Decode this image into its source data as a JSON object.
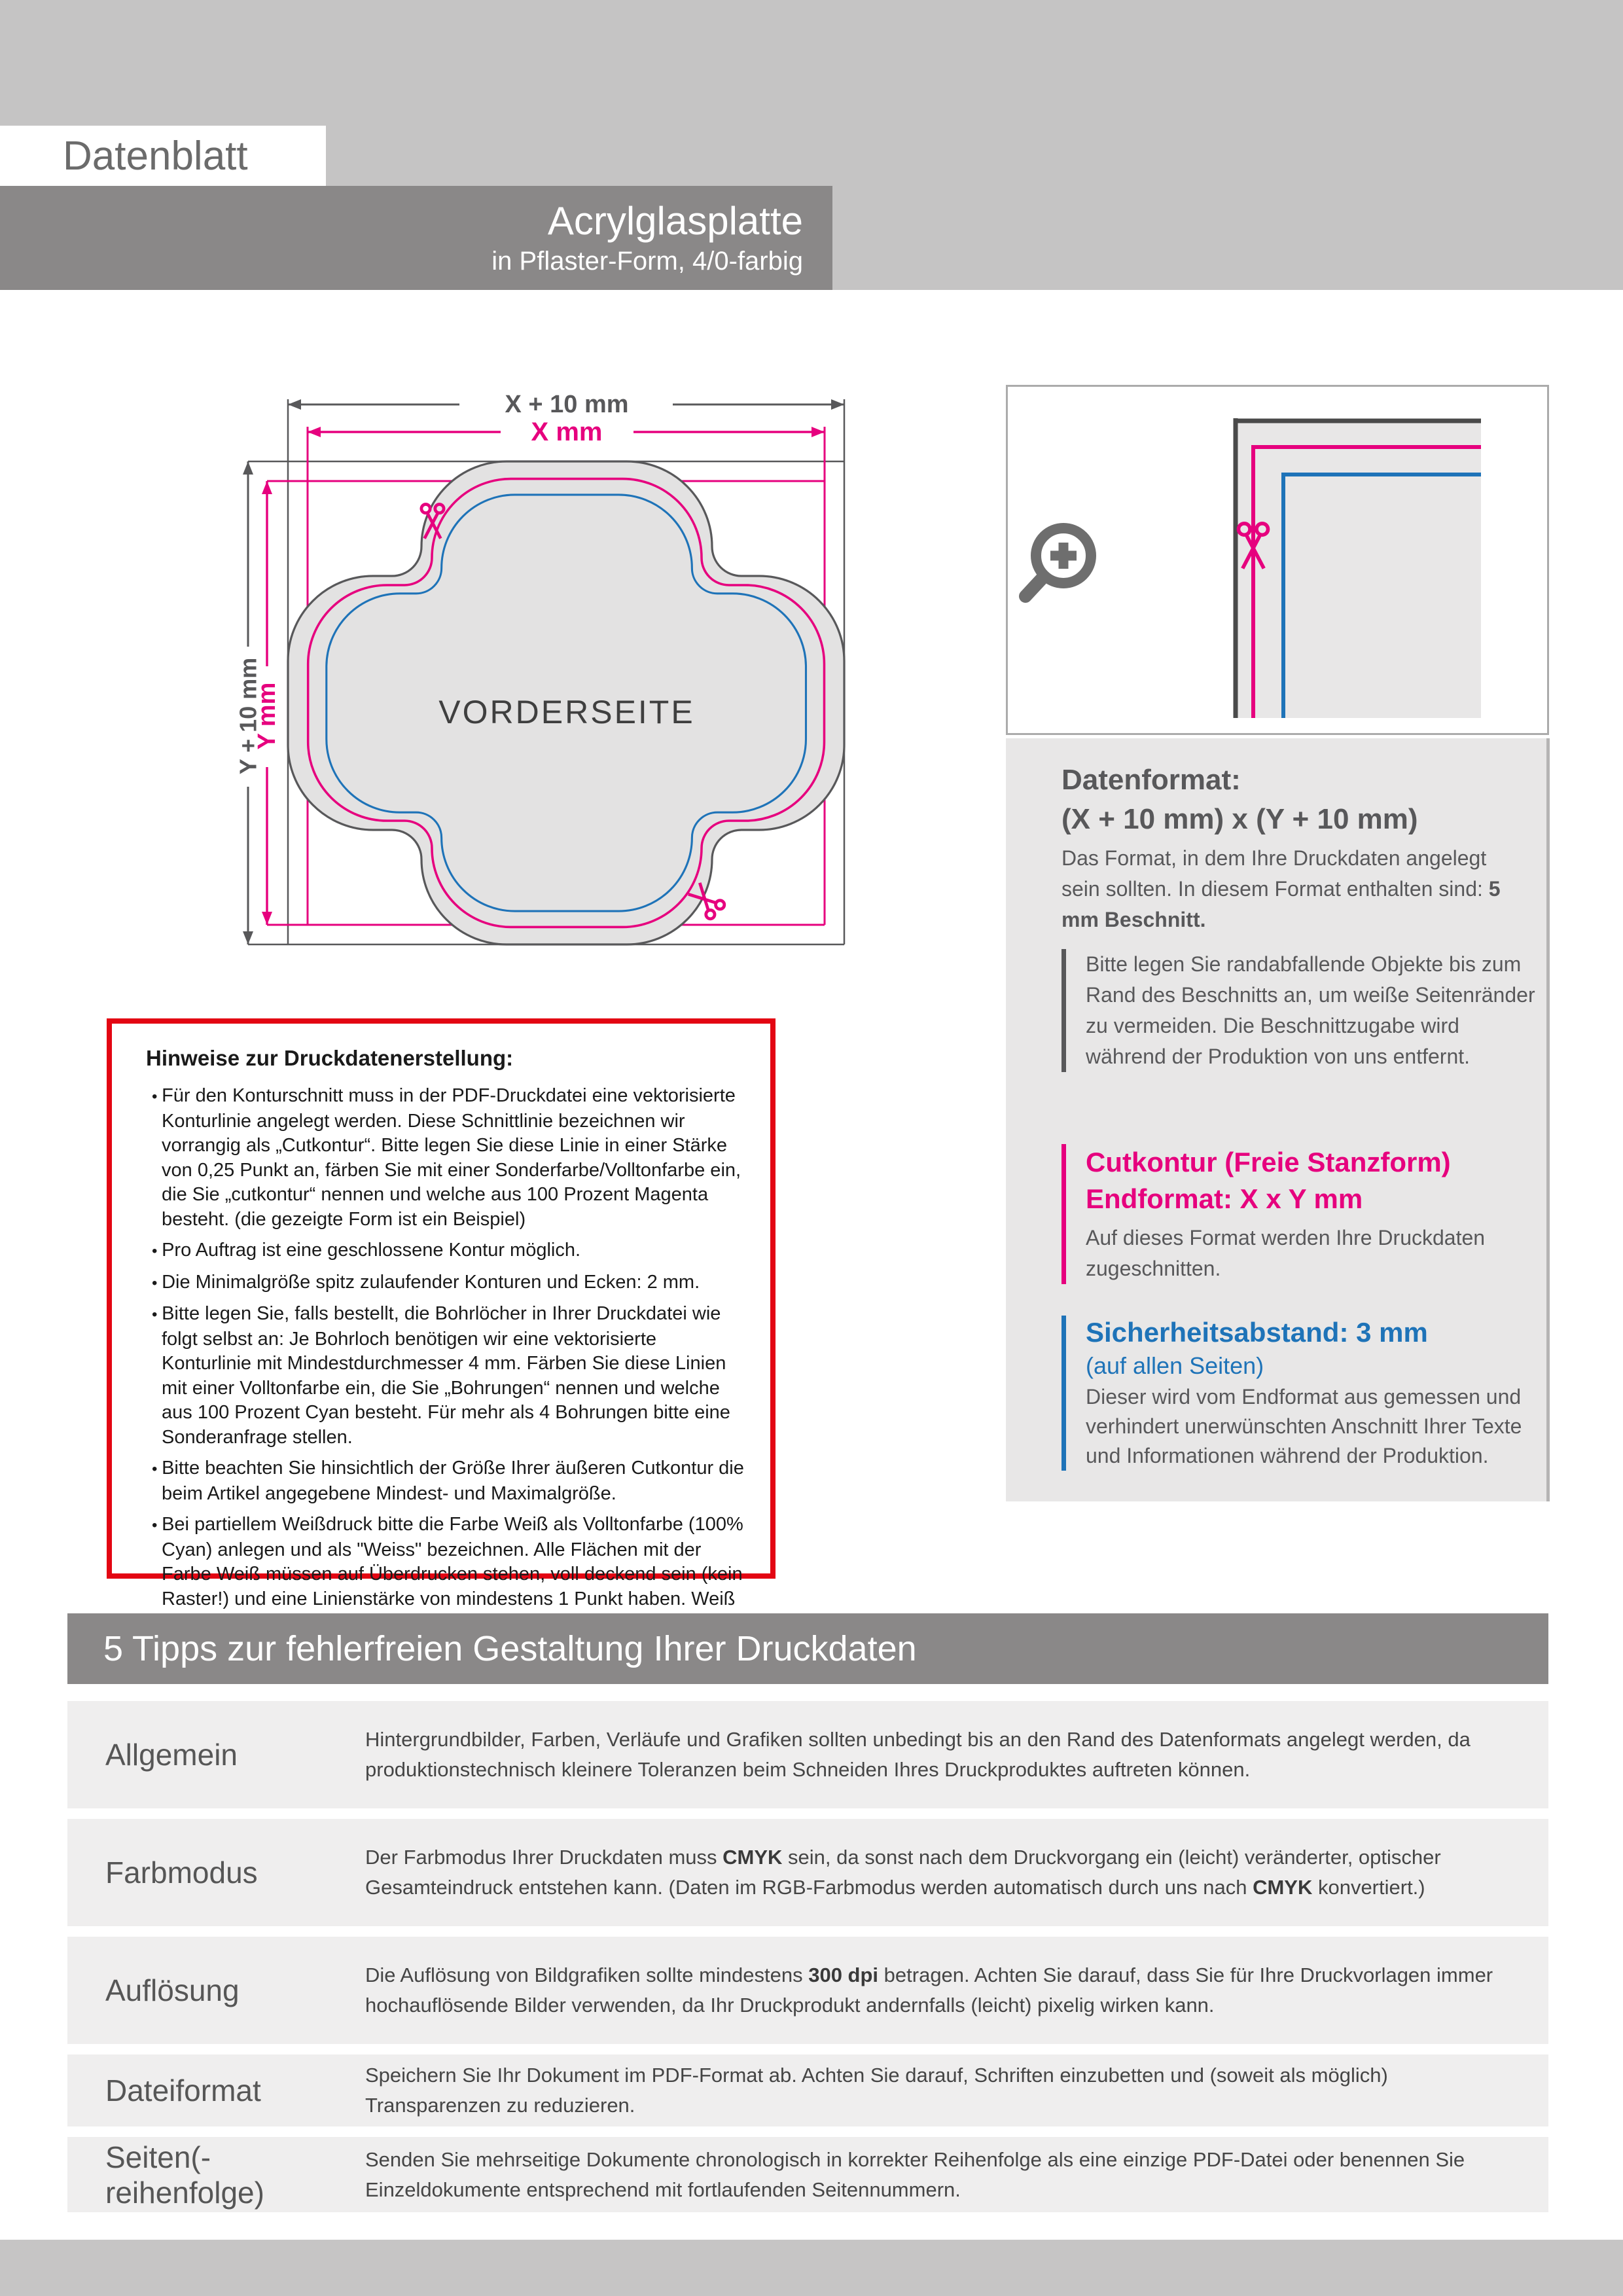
{
  "header": {
    "doc_label": "Datenblatt",
    "product_title": "Acrylglasplatte",
    "product_subtitle": "in Pflaster-Form, 4/0-farbig"
  },
  "colors": {
    "light_gray_band": "#c5c4c4",
    "dark_gray_bar": "#8a8888",
    "cut_magenta": "#e6007e",
    "safety_blue": "#1e73b8",
    "warn_red": "#e30613",
    "line_gray": "#58585a"
  },
  "diagram": {
    "dim_x_outer": "X + 10 mm",
    "dim_x_inner": "X mm",
    "dim_y_outer": "Y + 10 mm",
    "dim_y_inner": "Y mm",
    "front_label": "VORDERSEITE"
  },
  "info_panel": {
    "datenformat": {
      "title": "Datenformat:",
      "formula": "(X + 10 mm) x (Y + 10 mm)",
      "body_parts": [
        {
          "t": "Das Format, in dem Ihre Druckdaten angelegt sein sollten. In diesem Format enthalten sind: ",
          "b": false
        },
        {
          "t": "5 mm Beschnitt.",
          "b": true
        }
      ],
      "note": "Bitte legen Sie randabfallende Objekte bis zum Rand des Beschnitts an, um weiße Seitenränder zu vermeiden. Die Beschnittzugabe wird während der Produktion von uns entfernt."
    },
    "cutkontur": {
      "title_line1": "Cutkontur (Freie Stanzform)",
      "title_line2": "Endformat: X x Y mm",
      "body": "Auf dieses Format werden Ihre Druckdaten zugeschnitten."
    },
    "sicherheitsabstand": {
      "title": "Sicherheitsabstand: 3 mm",
      "subtitle": "(auf allen Seiten)",
      "body": "Dieser wird vom Endformat aus gemessen und verhindert unerwünschten Anschnitt Ihrer Texte und Informationen während der Produktion."
    }
  },
  "hinweise": {
    "title": "Hinweise zur Druckdatenerstellung:",
    "bullets": [
      "Für den Konturschnitt muss in der PDF-Druckdatei eine vektorisierte Konturlinie angelegt werden. Diese Schnittlinie bezeichnen wir vorrangig als „Cutkontur“. Bitte legen Sie diese Linie in einer Stärke von 0,25 Punkt an, färben Sie mit einer Sonderfarbe/Volltonfarbe ein, die Sie „cutkontur“ nennen und welche aus 100 Prozent Magenta besteht. (die gezeigte Form ist ein Beispiel)",
      "Pro Auftrag ist eine geschlossene Kontur möglich.",
      "Die Minimalgröße spitz zulaufender Konturen und Ecken: 2 mm.",
      "Bitte legen Sie, falls bestellt, die Bohrlöcher in Ihrer Druckdatei wie folgt selbst an: Je Bohrloch benötigen wir eine vektorisierte Konturlinie mit Mindestdurchmesser 4 mm. Färben Sie diese Linien mit einer Volltonfarbe ein, die Sie „Bohrungen“ nennen und welche aus 100 Prozent Cyan besteht. Für mehr als 4 Bohrungen bitte eine Sonderanfrage stellen.",
      "Bitte beachten Sie hinsichtlich der Größe Ihrer äußeren Cutkontur die beim Artikel angegebene Mindest- und Maximalgröße.",
      "Bei partiellem Weißdruck bitte die Farbe Weiß als Volltonfarbe (100% Cyan) anlegen und als \"Weiss\" bezeichnen. Alle Flächen mit der Farbe Weiß müssen auf Überdrucken stehen, voll deckend sein (kein Raster!) und eine Linienstärke von mindestens 1 Punkt haben. Weiß hinterlegten Schriften geben Sie bitte eine Mindestgröße von 15 pt."
    ]
  },
  "tips": {
    "banner": "5 Tipps zur fehlerfreien Gestaltung Ihrer Druckdaten",
    "rows": [
      {
        "label": "Allgemein",
        "parts": [
          {
            "t": "Hintergrundbilder, Farben, Verläufe und Grafiken sollten unbedingt bis an den Rand des Datenformats angelegt werden, da produktionstechnisch kleinere Toleranzen beim Schneiden Ihres Druckproduktes auftreten können.",
            "b": false
          }
        ]
      },
      {
        "label": "Farbmodus",
        "parts": [
          {
            "t": "Der Farbmodus Ihrer Druckdaten muss ",
            "b": false
          },
          {
            "t": "CMYK",
            "b": true
          },
          {
            "t": " sein, da sonst nach dem Druckvorgang ein (leicht) veränderter, optischer Gesamteindruck entstehen kann. (Daten im RGB-Farbmodus werden automatisch durch uns nach ",
            "b": false
          },
          {
            "t": "CMYK",
            "b": true
          },
          {
            "t": " konvertiert.)",
            "b": false
          }
        ]
      },
      {
        "label": "Auflösung",
        "parts": [
          {
            "t": "Die Auflösung von Bildgrafiken sollte mindestens ",
            "b": false
          },
          {
            "t": "300 dpi",
            "b": true
          },
          {
            "t": " betragen. Achten Sie darauf, dass Sie für Ihre Druckvorlagen immer hochauflösende Bilder verwenden, da Ihr Druckprodukt andernfalls (leicht) pixelig wirken kann.",
            "b": false
          }
        ]
      },
      {
        "label": "Dateiformat",
        "parts": [
          {
            "t": "Speichern Sie Ihr Dokument im PDF-Format ab. Achten Sie darauf, Schriften einzubetten und (soweit als möglich) Transparenzen zu reduzieren.",
            "b": false
          }
        ]
      },
      {
        "label": "Seiten(-reihenfolge)",
        "parts": [
          {
            "t": "Senden Sie mehrseitige Dokumente chronologisch in korrekter Reihenfolge als eine einzige PDF-Datei oder benennen Sie Einzeldokumente entsprechend mit fortlaufenden Seitennummern.",
            "b": false
          }
        ]
      }
    ]
  }
}
